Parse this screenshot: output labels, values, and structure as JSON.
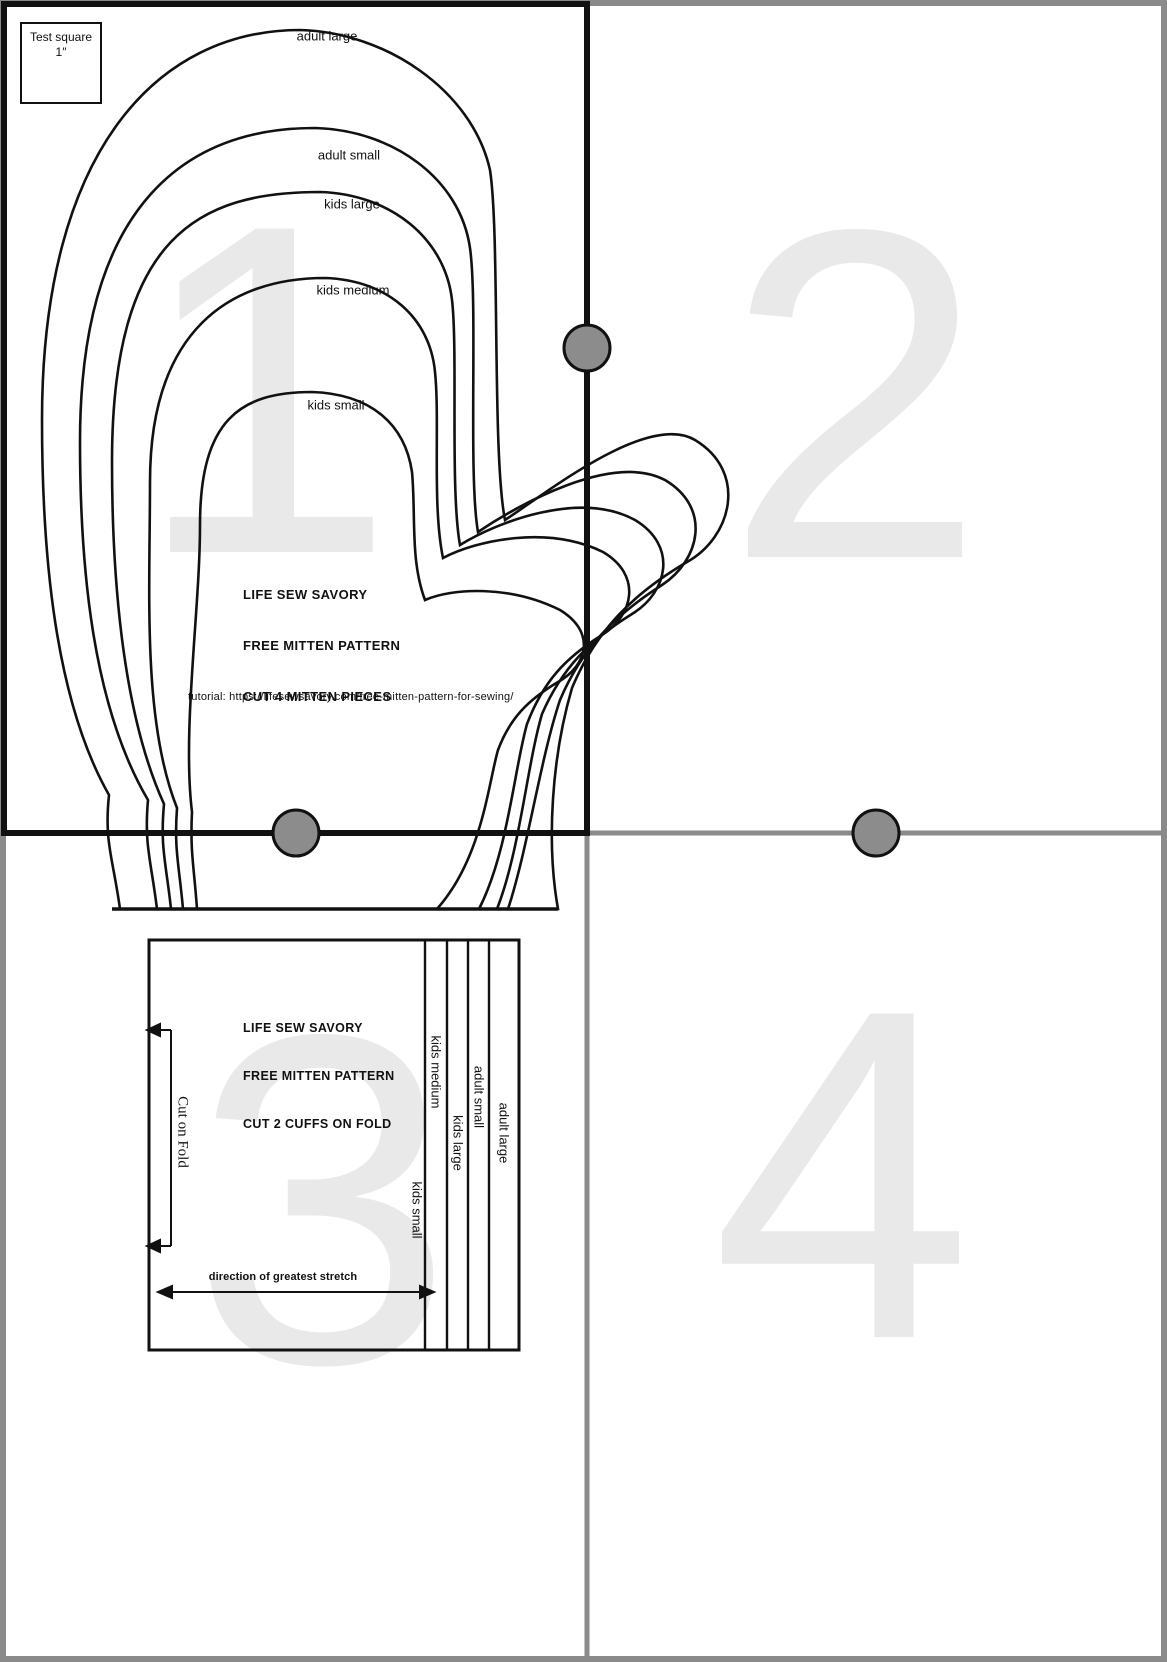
{
  "page_numbers": [
    "1",
    "2",
    "3",
    "4"
  ],
  "test_square": {
    "label": "Test square",
    "size": "1″"
  },
  "mitten": {
    "size_labels": [
      "adult large",
      "adult small",
      "kids large",
      "kids medium",
      "kids small"
    ],
    "brand_lines": [
      "LIFE SEW SAVORY",
      "FREE MITTEN PATTERN",
      "CUT 4 MITTEN PIECES"
    ],
    "tutorial": "tutorial:  https://lifesewsavory.com/free-mitten-pattern-for-sewing/"
  },
  "cuff": {
    "brand_lines": [
      "LIFE SEW SAVORY",
      "FREE MITTEN PATTERN",
      "CUT 2 CUFFS ON FOLD"
    ],
    "fold_label": "Cut on Fold",
    "stretch_label": "direction of greatest stretch",
    "size_labels": [
      "kids medium",
      "kids large",
      "adult small",
      "adult large",
      "kids small"
    ]
  },
  "colors": {
    "line": "#111111",
    "divider_gray": "#8a8a8a",
    "page_number_gray": "#e9e9e9",
    "dot_fill": "#8c8c8c"
  }
}
